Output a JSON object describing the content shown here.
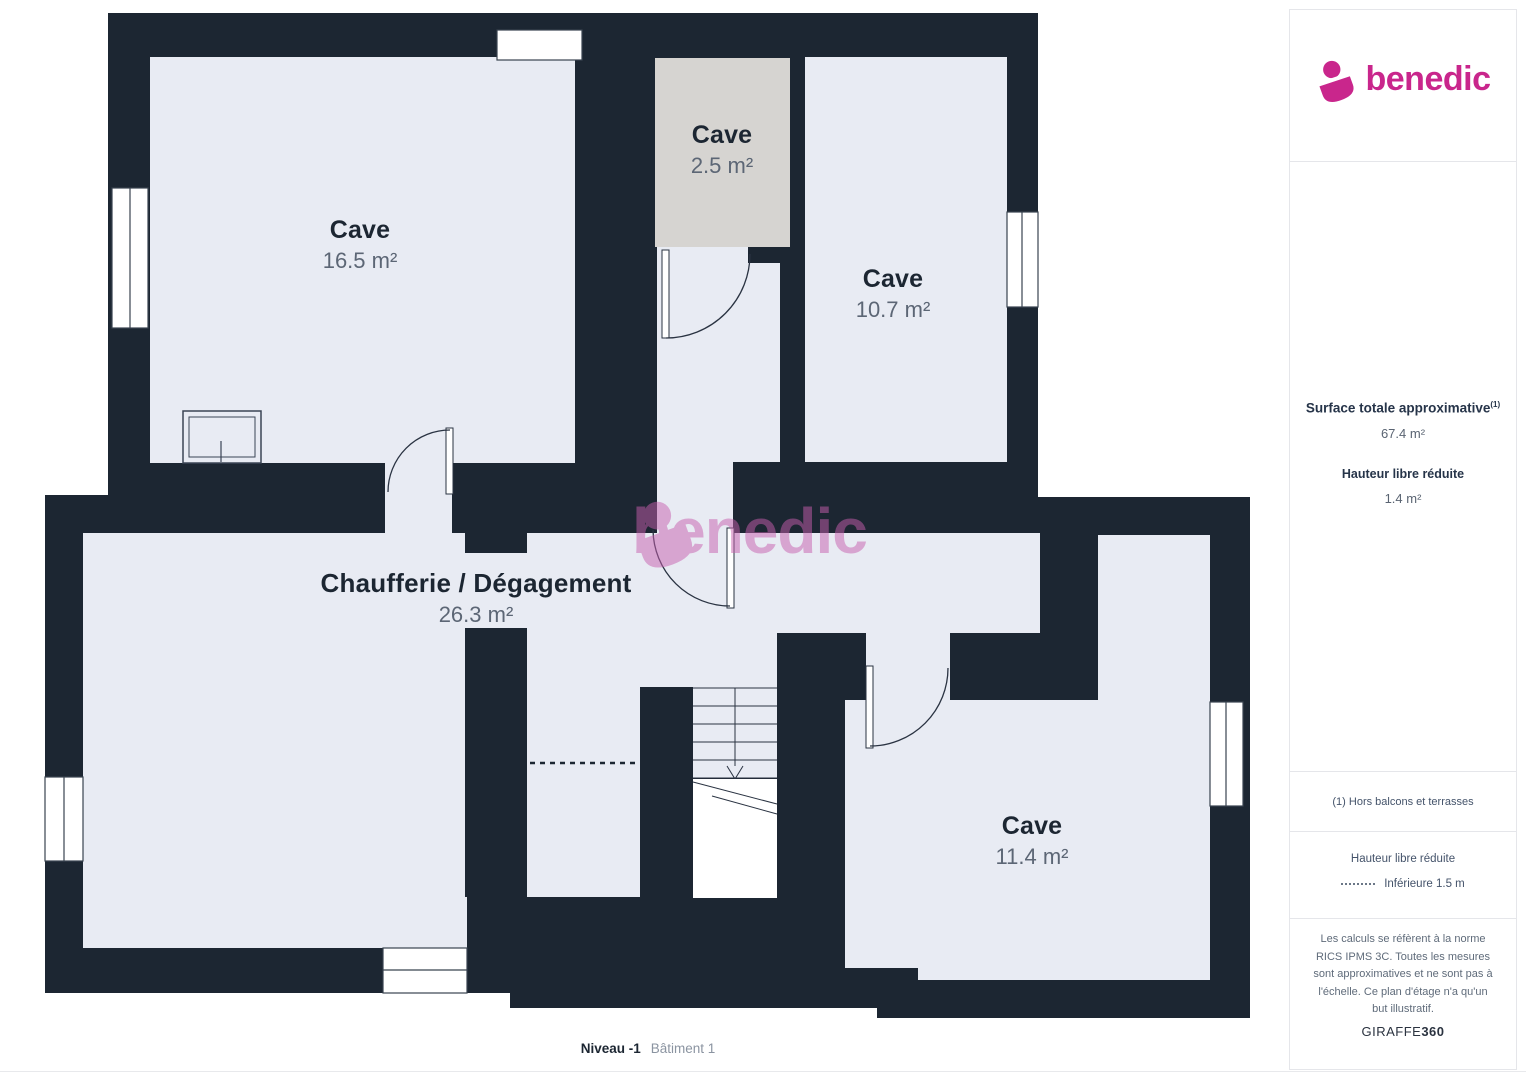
{
  "plan": {
    "rooms": [
      {
        "id": "cave-165",
        "name": "Cave",
        "area": "16.5 m²"
      },
      {
        "id": "cave-25",
        "name": "Cave",
        "area": "2.5 m²",
        "note": "reduced-height floor (gray)"
      },
      {
        "id": "cave-107",
        "name": "Cave",
        "area": "10.7 m²"
      },
      {
        "id": "chaufferie",
        "name": "Chaufferie / Dégagement",
        "area": "26.3 m²"
      },
      {
        "id": "cave-114",
        "name": "Cave",
        "area": "11.4 m²"
      }
    ],
    "footer": {
      "level": "Niveau -1",
      "building": "Bâtiment 1"
    },
    "watermark": {
      "text": "benedic",
      "icon": "benedic-heart-icon"
    }
  },
  "sidebar": {
    "brand": "benedic",
    "surface_title": "Surface totale approximative",
    "surface_sup": "(1)",
    "surface_value": "67.4 m²",
    "height_title": "Hauteur libre réduite",
    "height_value": "1.4 m²",
    "note": "(1) Hors balcons et terrasses",
    "legend_title": "Hauteur libre réduite",
    "legend_value": "Inférieure 1.5 m",
    "disclaimer": "Les calculs se réfèrent à la norme RICS IPMS 3C. Toutes les mesures sont approximatives et ne sont pas à l'échelle. Ce plan d'étage n'a qu'un but illustratif.",
    "maker": "GIRAFFE",
    "maker_suffix": "360"
  },
  "colors": {
    "wall": "#1c2632",
    "room": "#e8ebf3",
    "reduced_room": "#d6d4d1",
    "brand_pink": "#c9268c",
    "watermark_pink": "#c75fae",
    "label_dark": "#1c2632",
    "label_gray": "#5c6675"
  }
}
